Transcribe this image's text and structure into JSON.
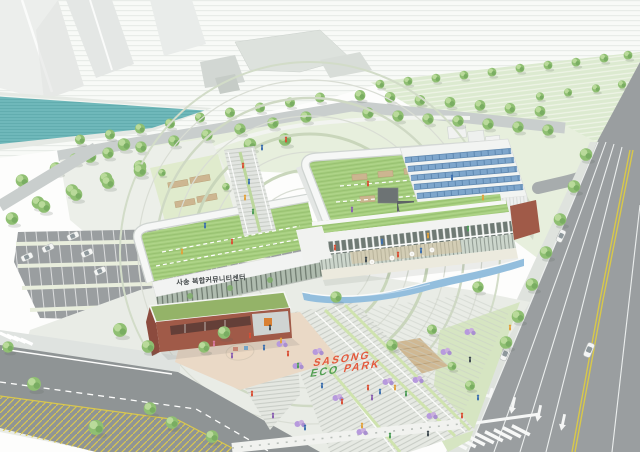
{
  "signs": {
    "building": "사송 복합커뮤니티센터",
    "park_word1": "SASONG",
    "park_word2": "ECO",
    "park_word3": "PARK"
  },
  "palette": {
    "tree": "#8fbf72",
    "roof": "#a5cd7e",
    "water": "#6fb8ba",
    "pool": "#93bedd",
    "roadMain": "#9a9ea0",
    "roadMinor": "#8f9495",
    "brick": "#a05a48",
    "solar": "#7ea6cc",
    "shrub": "#b79add",
    "signOrange": "#e4593c",
    "signGreen": "#4f9e4f",
    "laneYellow": "#d8c84a"
  }
}
